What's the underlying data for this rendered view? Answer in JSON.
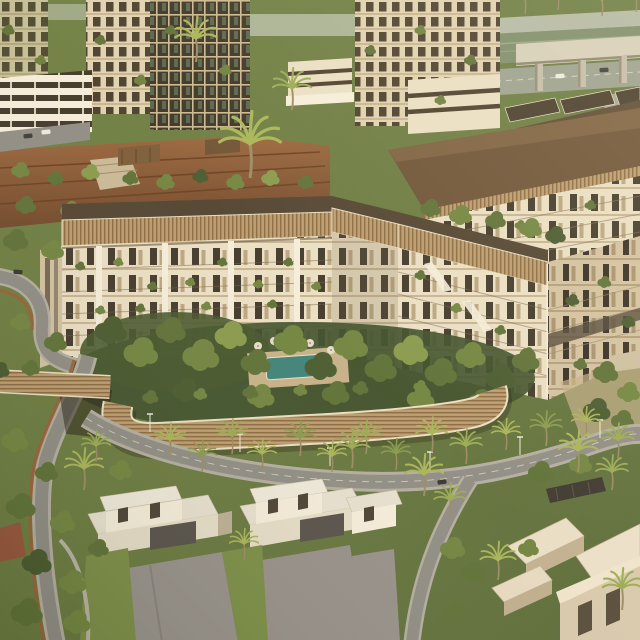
{
  "canvas": {
    "width": 640,
    "height": 640
  },
  "scene": {
    "description": "Aerial render of a residential development: V-shaped mid-rise courtyard apartment building with bronze louvered parapets and curved podium wall, high-rise towers behind, highway overpass at top right, terraced gardens, courtyard pool with umbrellas, palm-lined boulevard, and modern villas in the foreground",
    "elements": [
      {
        "name": "tower-cluster-left",
        "label": "High-rise residential towers, top left"
      },
      {
        "name": "tower-cluster-center",
        "label": "High-rise residential towers, top center"
      },
      {
        "name": "highway-overpass",
        "label": "Highway with concrete overpass, top right"
      },
      {
        "name": "terraced-gardens",
        "label": "Terraced rust-colored garden slope with timber pavilions"
      },
      {
        "name": "midrise-block-right",
        "label": "Mid-rise block with brown roof and bronze fascia"
      },
      {
        "name": "rooftop-pool-deck",
        "label": "Rooftop amenity deck with lap pool"
      },
      {
        "name": "main-courtyard-building",
        "label": "V-shaped courtyard apartment building with louvered parapet"
      },
      {
        "name": "courtyard-garden",
        "label": "Courtyard garden with swimming pool and umbrellas"
      },
      {
        "name": "podium-louver-wall",
        "label": "Curved bronze louvered podium wall and pedestrian bridge"
      },
      {
        "name": "boulevard",
        "label": "Palm-lined boulevard with street lights"
      },
      {
        "name": "white-villas",
        "label": "Modern white flat-roof villas with driveways"
      },
      {
        "name": "beige-villas",
        "label": "Beige villas, bottom right"
      },
      {
        "name": "road-loop-left",
        "label": "Curved road with brown jogging track, left side"
      }
    ]
  },
  "palette": {
    "foliage_dark": "#46552c",
    "foliage_mid": "#5e7036",
    "foliage_light": "#7f9245",
    "palm_green": "#a9b457",
    "facade_cream": "#eadec4",
    "facade_bright": "#f5edda",
    "facade_shadow": "#d3c1a0",
    "window_dark": "#41382a",
    "bronze": "#b29066",
    "bronze_dark": "#8a6a42",
    "bronze_light": "#c9aa78",
    "roof_dark": "#514330",
    "roof_brown": "#6d5236",
    "terrace_rust": "#8a5732",
    "road_gray": "#8f8c84",
    "sidewalk": "#b3ada0",
    "concrete": "#d6cfba",
    "pool_teal": "#3d8278",
    "lawn_green": "#7b8d46",
    "driveway_gray": "#96908a",
    "villa_white": "#efe9da",
    "villa_tan": "#d9c9ac",
    "villa_shadow": "#bcae94",
    "ground_tan": "#c4af87",
    "track_brown": "#9a5f36"
  }
}
